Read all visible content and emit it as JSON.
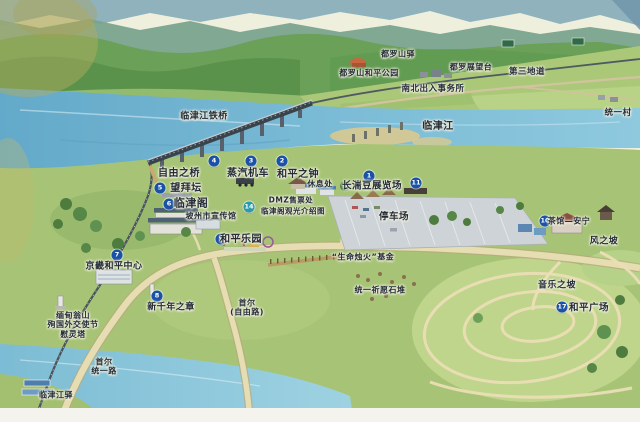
{
  "map": {
    "description_labels_language": "zh",
    "colors": {
      "marker_blue": "#1a52a8",
      "marker_teal": "#2d9aa8",
      "label_ink": "#242c36",
      "river": "#6fb0cd",
      "land_green": "#a7c476",
      "mountain_green": "#6aa058",
      "parking_gray": "#cdd3d6",
      "road_cream": "#e7ddb2",
      "paper": "#f2efe3"
    },
    "markers": [
      {
        "id": "marker-1-jangdan-bean-expo",
        "n": "1",
        "x": 369,
        "y": 176,
        "color": "#1a52a8"
      },
      {
        "id": "marker-2-peace-bell",
        "n": "2",
        "x": 282,
        "y": 161,
        "color": "#1a52a8"
      },
      {
        "id": "marker-3-steam-locomotive",
        "n": "3",
        "x": 251,
        "y": 161,
        "color": "#1a52a8"
      },
      {
        "id": "marker-4-freedom-bridge",
        "n": "4",
        "x": 214,
        "y": 161,
        "color": "#1a52a8"
      },
      {
        "id": "marker-5-mangbaedan",
        "n": "5",
        "x": 160,
        "y": 188,
        "color": "#1a52a8"
      },
      {
        "id": "marker-6-imjingak",
        "n": "6",
        "x": 169,
        "y": 204,
        "color": "#1a52a8"
      },
      {
        "id": "marker-7-gyeonggi-peace-center",
        "n": "7",
        "x": 117,
        "y": 255,
        "color": "#1a52a8"
      },
      {
        "id": "marker-8-new-millennium",
        "n": "8",
        "x": 157,
        "y": 296,
        "color": "#1a52a8"
      },
      {
        "id": "marker-9-peace-land",
        "n": "9",
        "x": 221,
        "y": 239,
        "color": "#1a52a8"
      },
      {
        "id": "marker-10-teahouse",
        "n": "10",
        "x": 545,
        "y": 221,
        "color": "#1a52a8"
      },
      {
        "id": "marker-11-parking-area",
        "n": "11",
        "x": 416,
        "y": 183,
        "color": "#1a52a8"
      },
      {
        "id": "marker-14-dmz-ticket",
        "n": "14",
        "x": 249,
        "y": 207,
        "color": "#2d9aa8"
      },
      {
        "id": "marker-17-peace-plaza",
        "n": "17",
        "x": 562,
        "y": 307,
        "color": "#1a52a8"
      }
    ],
    "labels": [
      {
        "id": "dorasan-station",
        "lines": [
          "都罗山驿"
        ],
        "x": 398,
        "y": 54,
        "size": 8
      },
      {
        "id": "dorasan-peace-park",
        "lines": [
          "都罗山和平公园"
        ],
        "x": 369,
        "y": 73,
        "size": 8
      },
      {
        "id": "dora-observatory",
        "lines": [
          "都罗展望台"
        ],
        "x": 471,
        "y": 67,
        "size": 8
      },
      {
        "id": "third-tunnel",
        "lines": [
          "第三地道"
        ],
        "x": 527,
        "y": 72,
        "size": 8.5
      },
      {
        "id": "inter-korean-transit-office",
        "lines": [
          "南北出入事务所"
        ],
        "x": 433,
        "y": 89,
        "size": 8.5
      },
      {
        "id": "tongil-village",
        "lines": [
          "统一村"
        ],
        "x": 618,
        "y": 113,
        "size": 8.5
      },
      {
        "id": "imjingang-rail-bridge",
        "lines": [
          "临津江铁桥"
        ],
        "x": 204,
        "y": 117,
        "size": 9
      },
      {
        "id": "imjin-river",
        "lines": [
          "临津江"
        ],
        "x": 438,
        "y": 127,
        "size": 10
      },
      {
        "id": "freedom-bridge",
        "lines": [
          "自由之桥"
        ],
        "x": 179,
        "y": 174,
        "size": 10
      },
      {
        "id": "steam-locomotive",
        "lines": [
          "蒸汽机车"
        ],
        "x": 248,
        "y": 174,
        "size": 10
      },
      {
        "id": "peace-bell",
        "lines": [
          "和平之钟"
        ],
        "x": 298,
        "y": 175,
        "size": 10
      },
      {
        "id": "mangbaedan",
        "lines": [
          "望拜坛"
        ],
        "x": 186,
        "y": 189,
        "size": 10
      },
      {
        "id": "imjingak-pavilion",
        "lines": [
          "临津阁"
        ],
        "x": 191,
        "y": 204,
        "size": 11
      },
      {
        "id": "paju-promotion-hall",
        "lines": [
          "坡州市宣传馆"
        ],
        "x": 211,
        "y": 216,
        "size": 8
      },
      {
        "id": "rest-area",
        "lines": [
          "休息处"
        ],
        "x": 320,
        "y": 184,
        "size": 8
      },
      {
        "id": "jangdan-bean-expo",
        "lines": [
          "长湍豆展览场"
        ],
        "x": 372,
        "y": 186,
        "size": 9.5
      },
      {
        "id": "dmz-ticket-office",
        "lines": [
          "DMZ售票处"
        ],
        "x": 291,
        "y": 201,
        "size": 7.5
      },
      {
        "id": "imjingak-tour-map",
        "lines": [
          "临津阁观光介绍图"
        ],
        "x": 293,
        "y": 212,
        "size": 7.5
      },
      {
        "id": "parking-lot",
        "lines": [
          "停车场"
        ],
        "x": 394,
        "y": 217,
        "size": 9.5
      },
      {
        "id": "peace-land",
        "lines": [
          "和平乐园"
        ],
        "x": 241,
        "y": 240,
        "size": 10
      },
      {
        "id": "gyeonggi-peace-center",
        "lines": [
          "京畿和平中心"
        ],
        "x": 114,
        "y": 267,
        "size": 9
      },
      {
        "id": "new-millennium-monument",
        "lines": [
          "新千年之章"
        ],
        "x": 171,
        "y": 308,
        "size": 9
      },
      {
        "id": "life-candle-fund",
        "lines": [
          "“生命烛火”基金"
        ],
        "x": 363,
        "y": 257,
        "size": 8
      },
      {
        "id": "unification-stone-cairns",
        "lines": [
          "统一祈愿石堆"
        ],
        "x": 380,
        "y": 290,
        "size": 8
      },
      {
        "id": "seoul-freedom-road",
        "lines": [
          "首尔",
          "(自由路)"
        ],
        "x": 247,
        "y": 308,
        "size": 8
      },
      {
        "id": "aungsan-martyrs-memorial",
        "lines": [
          "缅甸翁山",
          "殉国外交使节",
          "慰灵塔"
        ],
        "x": 73,
        "y": 325,
        "size": 8
      },
      {
        "id": "seoul-tongil-road",
        "lines": [
          "首尔",
          "统一路"
        ],
        "x": 104,
        "y": 367,
        "size": 8
      },
      {
        "id": "imjingang-station",
        "lines": [
          "临津江驿"
        ],
        "x": 56,
        "y": 395,
        "size": 8
      },
      {
        "id": "teahouse-annyeong",
        "lines": [
          "茶馆—安宁"
        ],
        "x": 569,
        "y": 221,
        "size": 8
      },
      {
        "id": "hill-of-wind",
        "lines": [
          "风之坡"
        ],
        "x": 604,
        "y": 242,
        "size": 9
      },
      {
        "id": "hill-of-music",
        "lines": [
          "音乐之坡"
        ],
        "x": 557,
        "y": 286,
        "size": 9
      },
      {
        "id": "peace-plaza",
        "lines": [
          "和平广场"
        ],
        "x": 589,
        "y": 308,
        "size": 9.5
      }
    ]
  }
}
